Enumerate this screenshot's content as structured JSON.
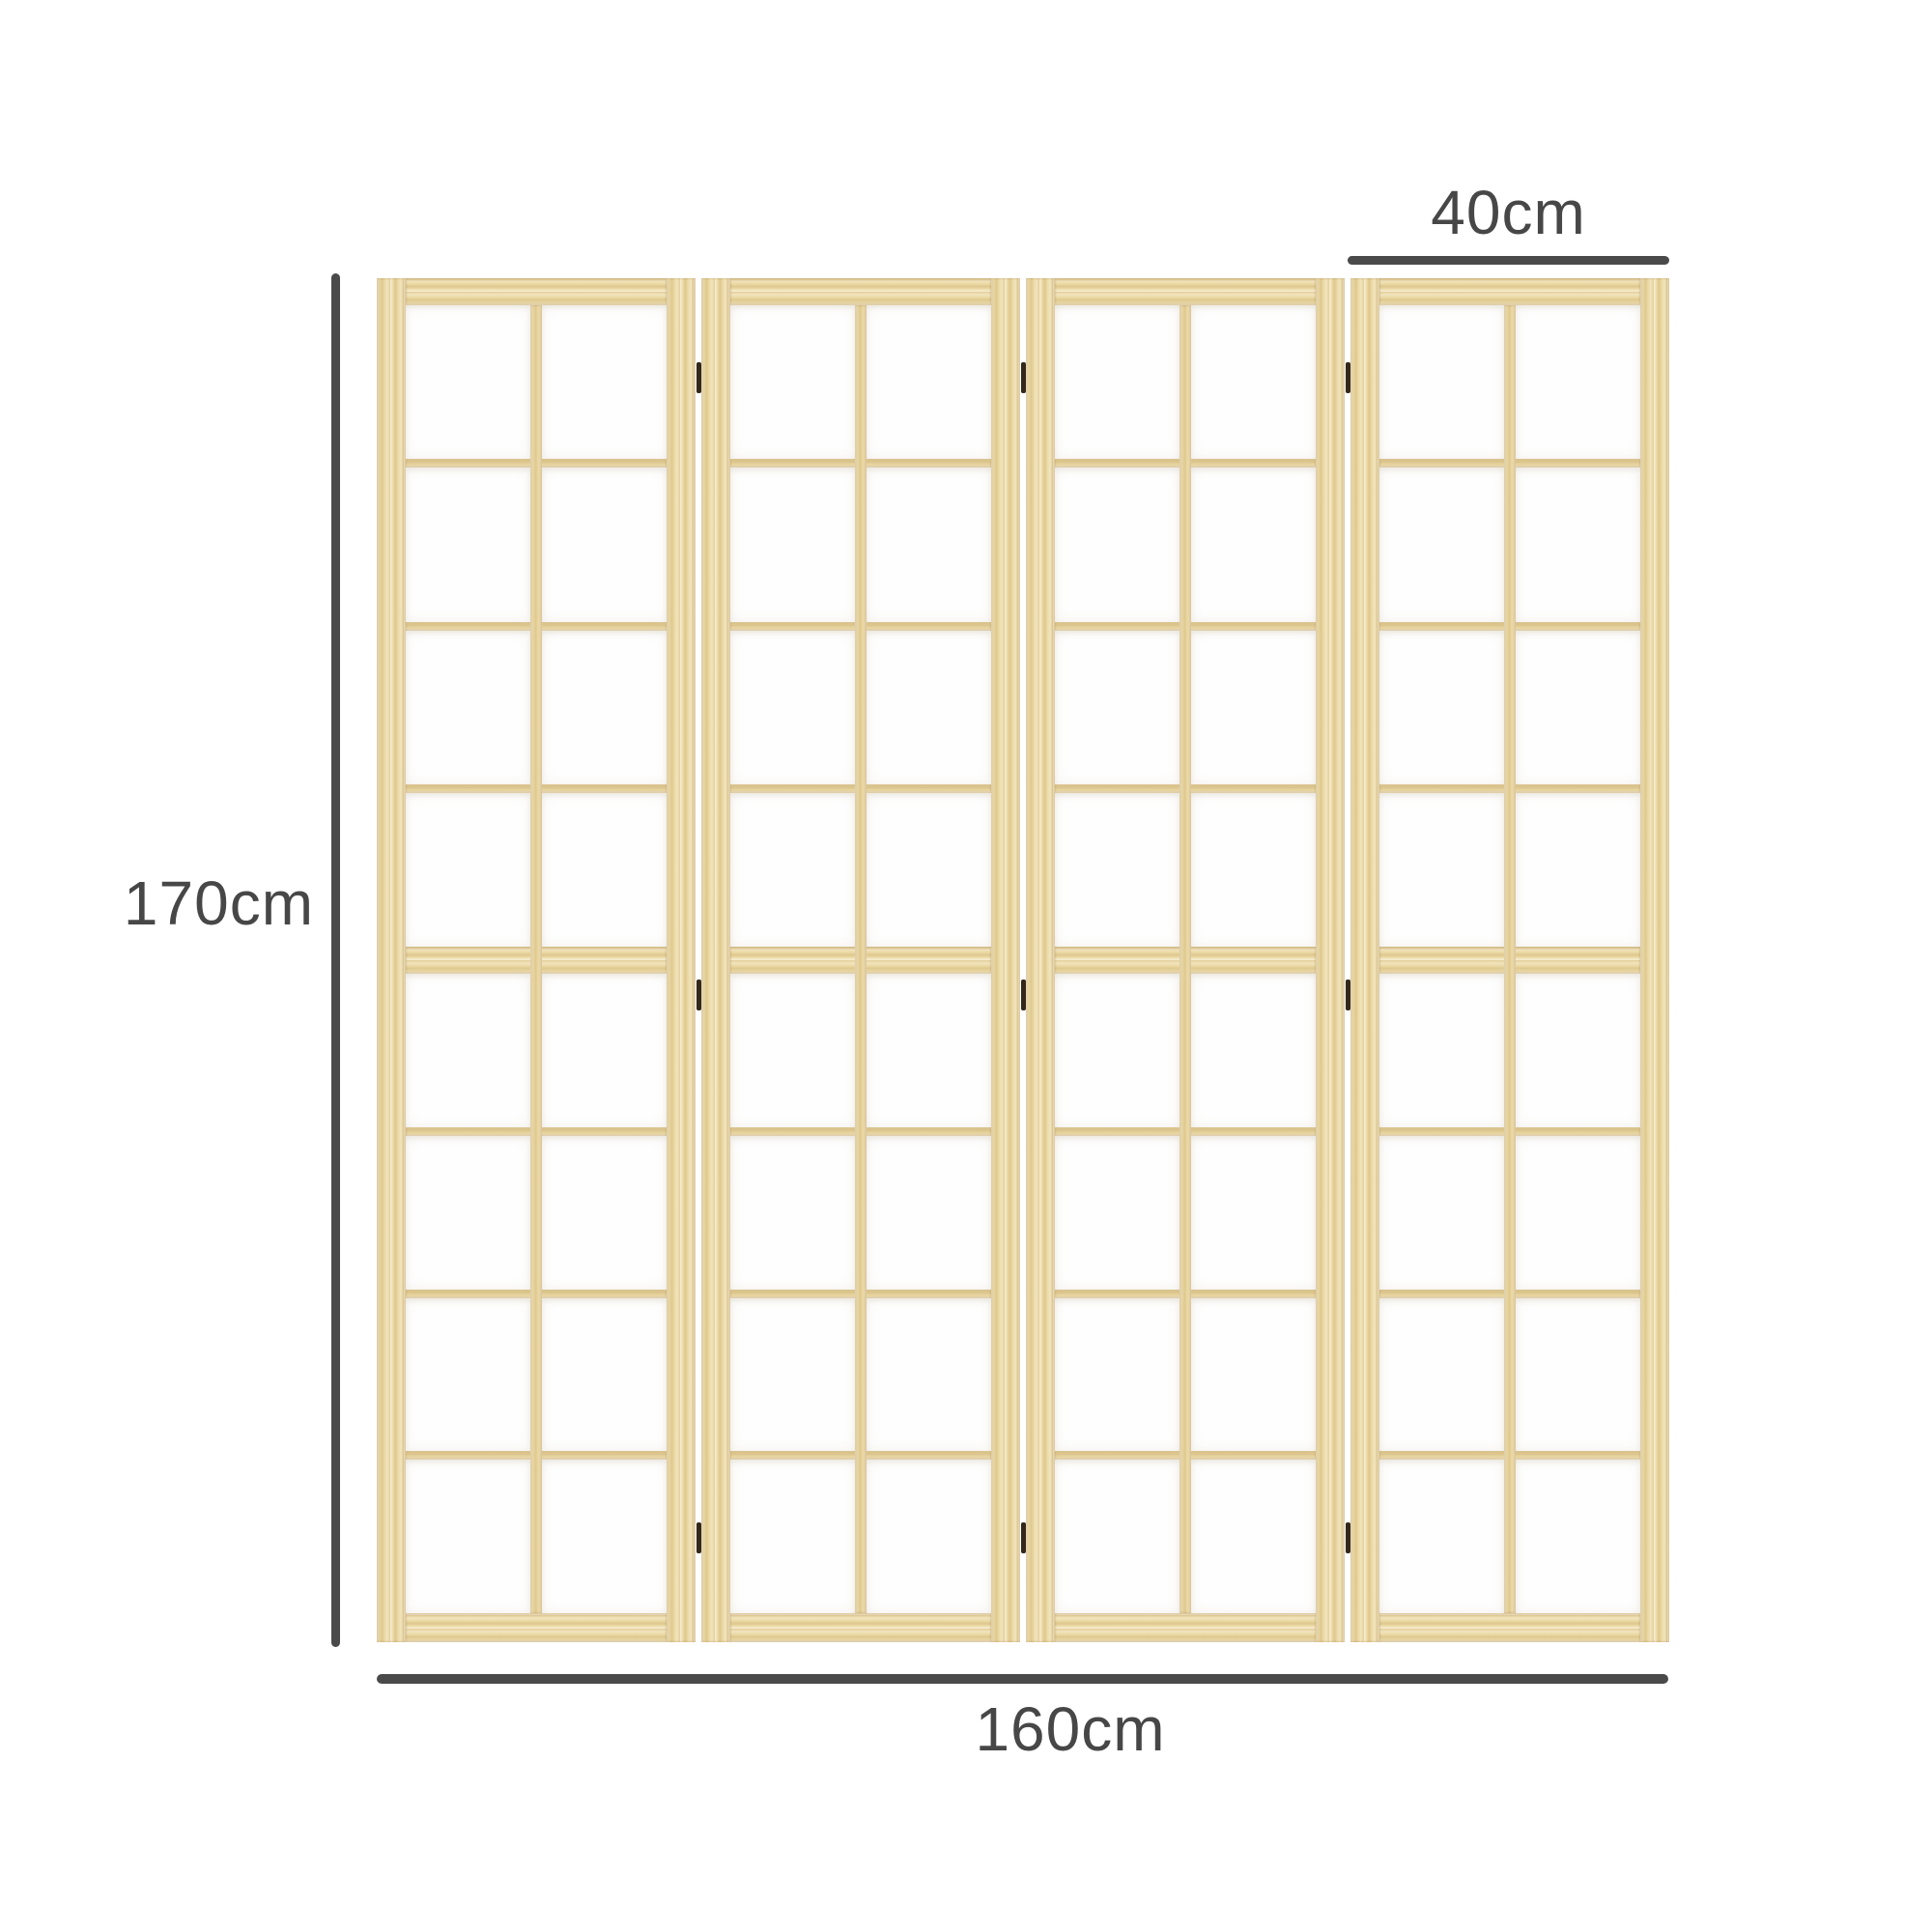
{
  "product": {
    "name": "4-panel wooden shoji-style folding room divider, dimension diagram",
    "panel_count": 4,
    "pane_columns_per_panel": 2,
    "pane_rows_per_panel": 8,
    "hinges_per_joint": 3
  },
  "dimensions": {
    "height_label": "170cm",
    "width_label": "160cm",
    "panel_width_label": "40cm"
  },
  "colors": {
    "background": "#ffffff",
    "wood_base": "#ecd9a3",
    "wood_light": "#f8f0d2",
    "wood_dark": "#d8be83",
    "pane": "#fefefe",
    "hinge": "#33281a",
    "dimension_line": "#4a4a4a",
    "dimension_text": "#474747"
  }
}
